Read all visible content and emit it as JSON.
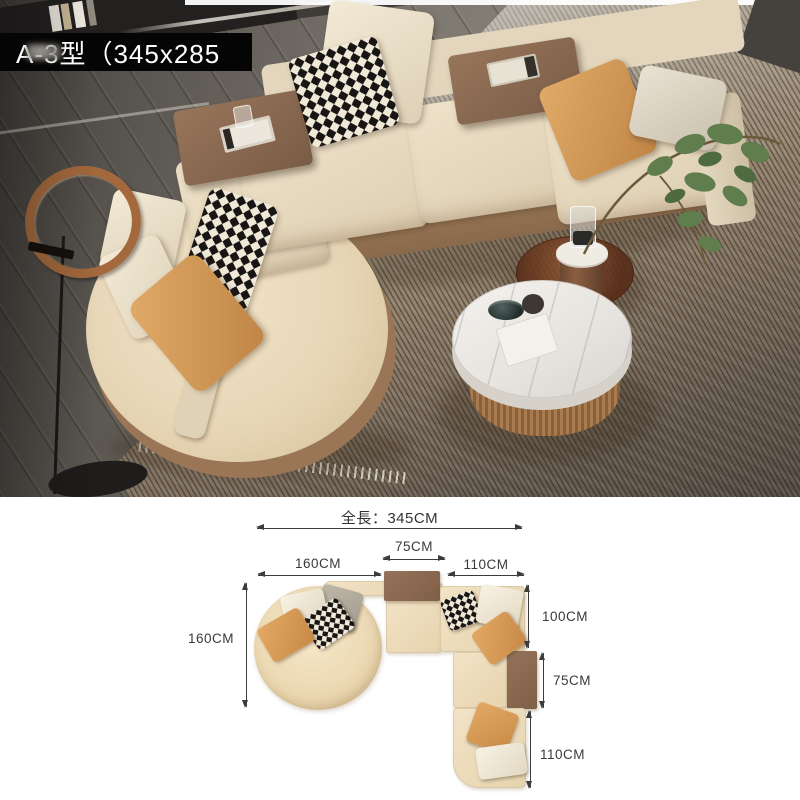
{
  "overlay": {
    "model_label": "A-3型（345x285",
    "watermark_icon": "blurred-watermark"
  },
  "diagram": {
    "total_length_label": "全長：345CM",
    "top_dims": {
      "left": "160CM",
      "middle": "75CM",
      "right": "110CM"
    },
    "left_dim": "160CM",
    "right_dims": {
      "top": "100CM",
      "middle": "75CM",
      "bottom": "110CM"
    }
  },
  "colors": {
    "sofa_cream": "#e8dcc4",
    "sofa_brown": "#8d6b51",
    "pillow_orange": "#d59a5a",
    "pillow_white": "#f0e8d6",
    "hound_dark": "#181614",
    "hound_light": "#f0e9d7",
    "lamp_copper": "#9c6236",
    "marble_white": "#efece7",
    "rug_light": "#c6c2bb",
    "rug_dark": "#5c5348",
    "wood_floor": "#7b766e",
    "dim_line": "#3c3c3c",
    "label_bar_bg": "#050505",
    "label_text": "#ffffff"
  }
}
